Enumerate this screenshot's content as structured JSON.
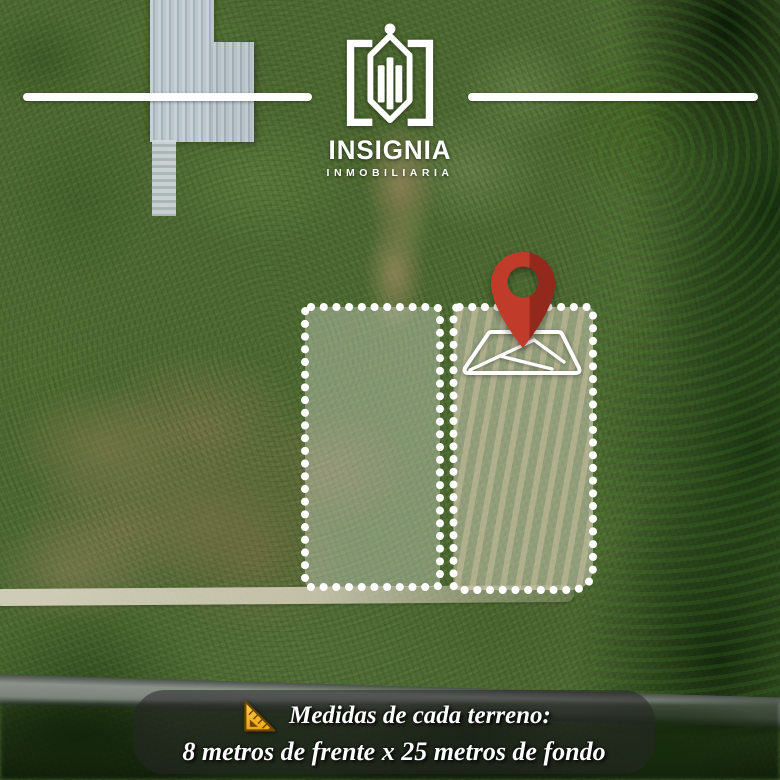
{
  "brand": {
    "name": "INSIGNIA",
    "subtitle": "INMOBILIARIA"
  },
  "caption": {
    "heading": "Medidas de cada terreno:",
    "detail": "8 metros de frente x 25 metros de fondo"
  },
  "plots": {
    "count": 2,
    "frontage_meters": 8,
    "depth_meters": 25
  },
  "icons": {
    "logo": "insignia-house-emblem",
    "pin": "location-pin",
    "lot": "land-lot-diagram",
    "ruler": "triangle-ruler"
  },
  "colors": {
    "pin_red": "#c13b2b",
    "pin_red_dark": "#93281c",
    "dot_white": "#ffffff",
    "plot_overlay": "rgba(255,255,255,0.32)",
    "caption_bg": "rgba(38,38,38,0.55)",
    "ruler_gold_light": "#fdd04a",
    "ruler_gold_dark": "#eda312",
    "text_white": "#ffffff"
  }
}
